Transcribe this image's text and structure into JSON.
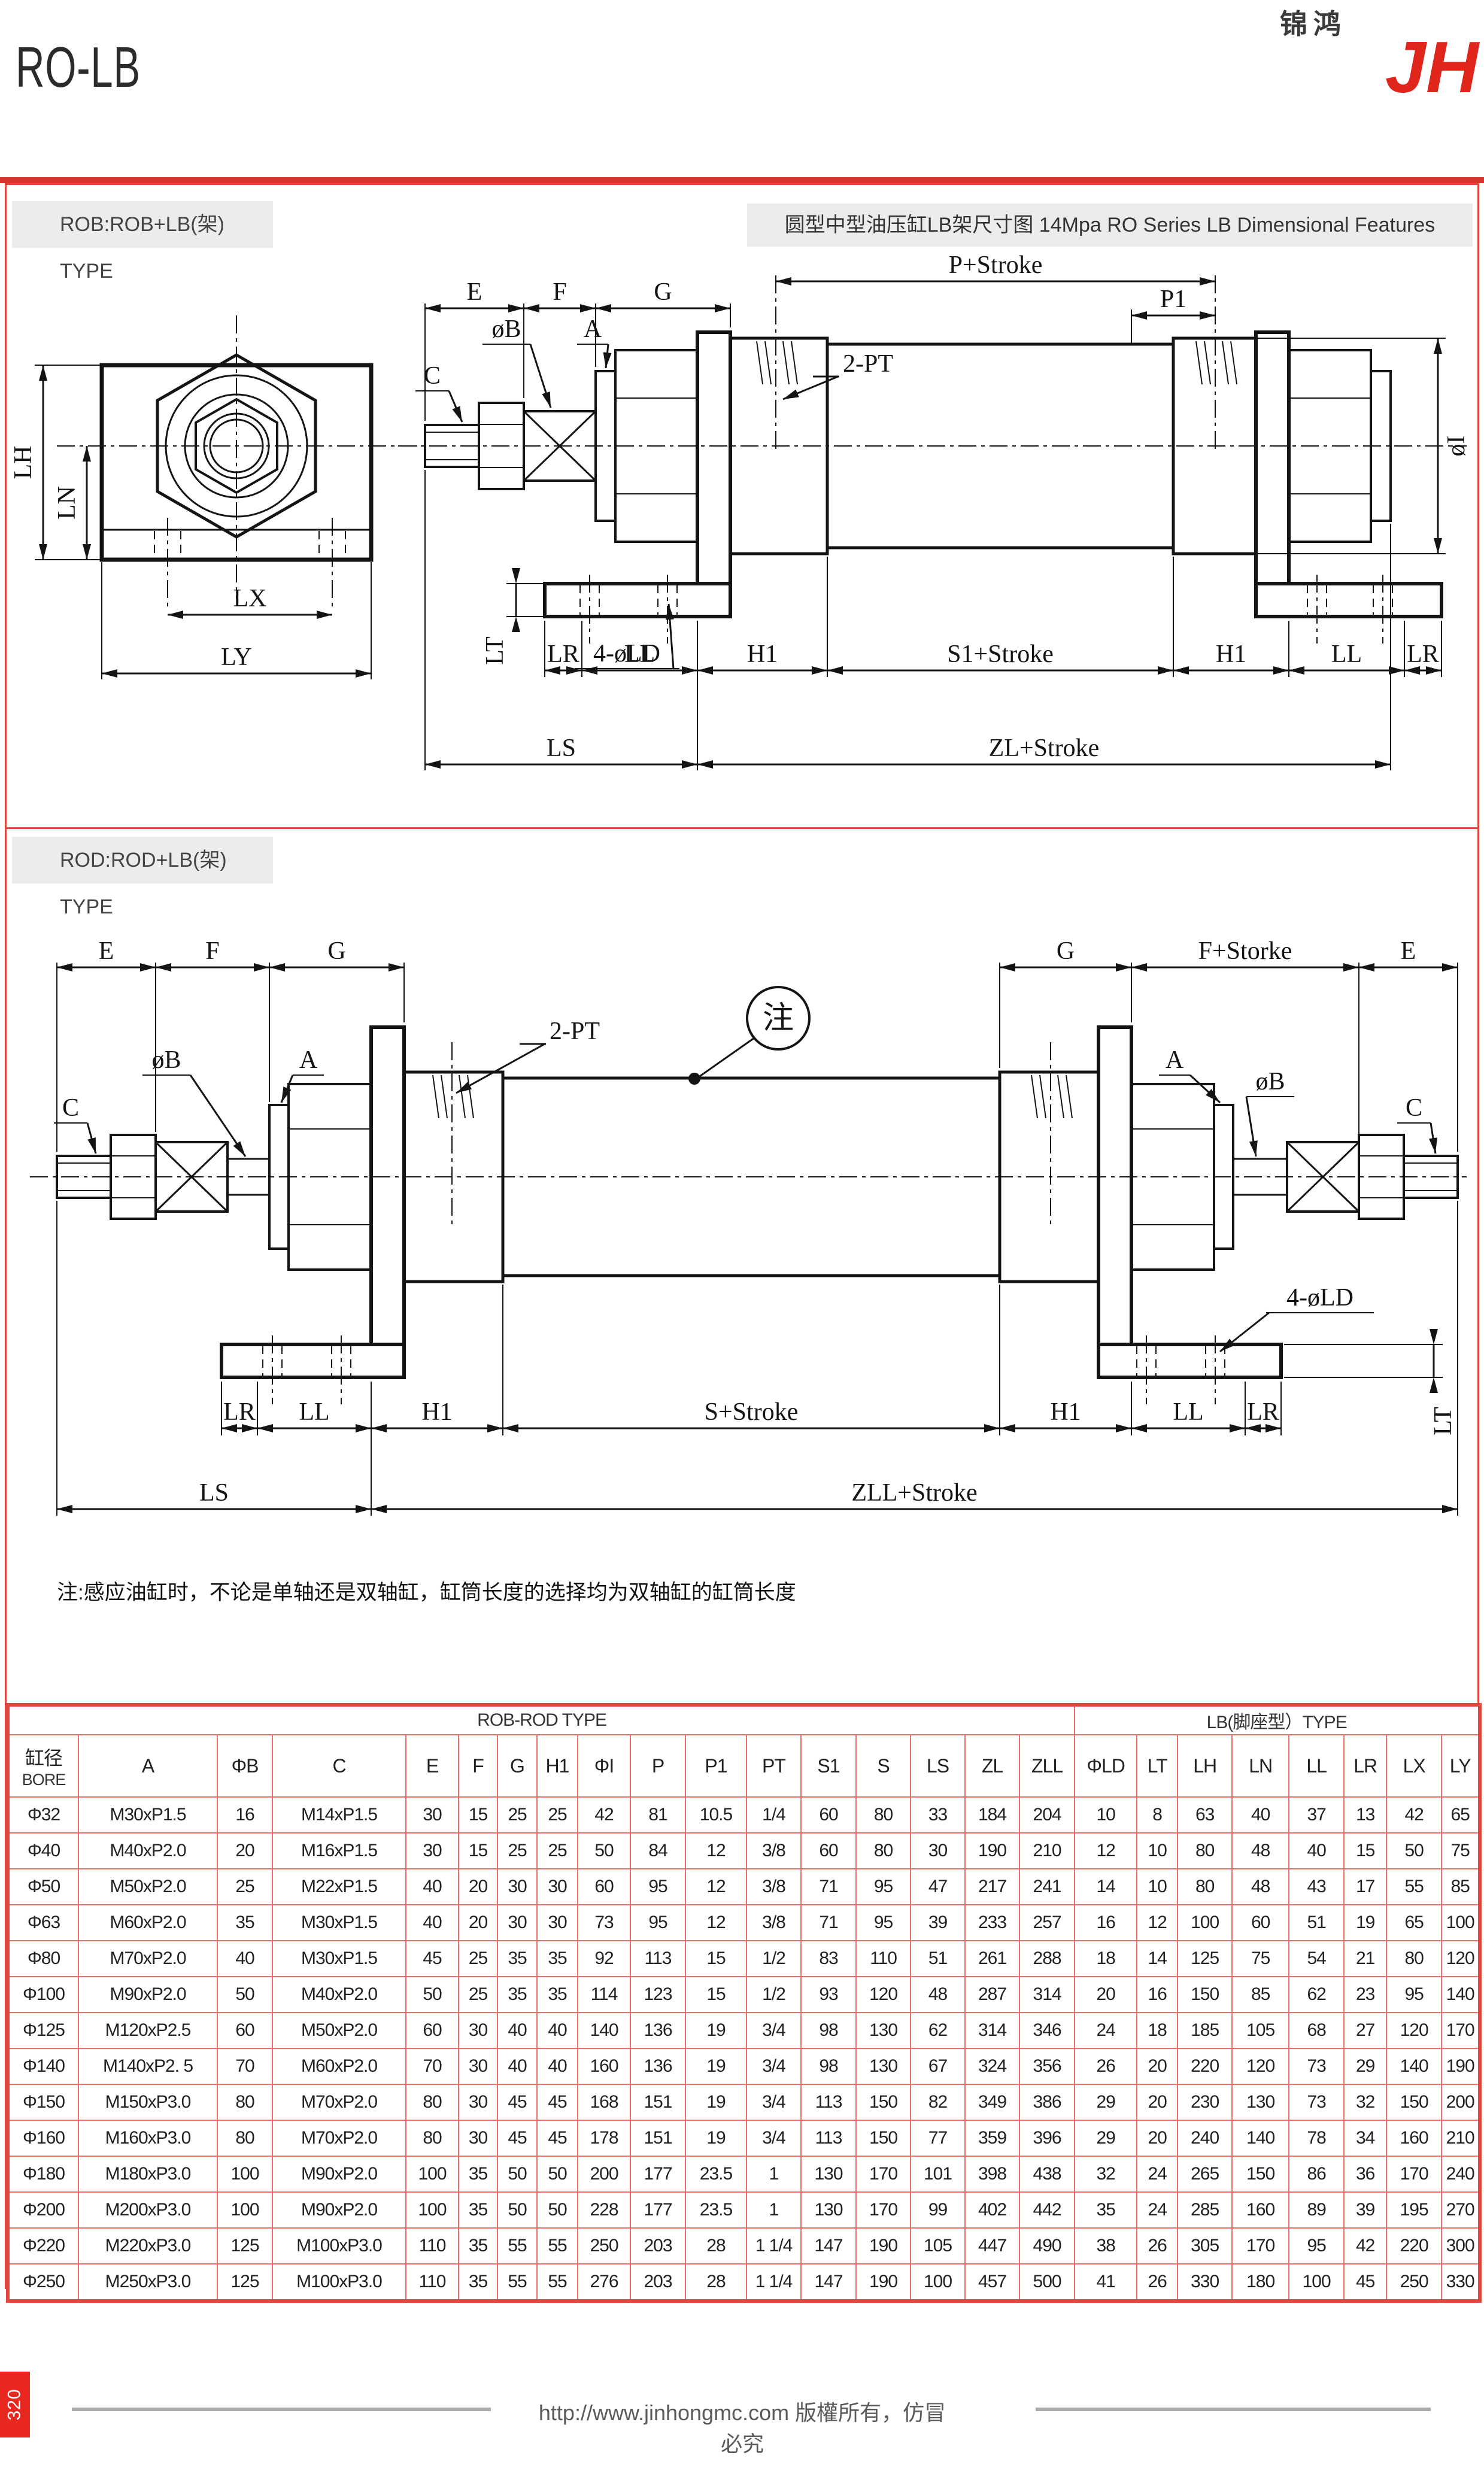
{
  "header": {
    "title": "RO-LB",
    "logo_cn": "锦鸿",
    "logo_latin": "JH"
  },
  "sec1": {
    "label": "ROB:ROB+LB(架) TYPE",
    "title": "圆型中型油压缸LB架尺寸图 14Mpa RO Series LB Dimensional Features"
  },
  "sec2": {
    "label": "ROD:ROD+LB(架) TYPE",
    "note": "注:感应油缸时，不论是单轴还是双轴缸，缸筒长度的选择均为双轴缸的缸筒长度"
  },
  "d1": {
    "E": "E",
    "F": "F",
    "G": "G",
    "P_stroke": "P+Stroke",
    "P1": "P1",
    "PT2": "2-PT",
    "C": "C",
    "phiB": "øB",
    "A": "A",
    "phiI": "øI",
    "LD4": "4-øLD",
    "LT": "LT",
    "LR": "LR",
    "LL": "LL",
    "H1": "H1",
    "S1_stroke": "S1+Stroke",
    "LS": "LS",
    "ZL_stroke": "ZL+Stroke",
    "LH": "LH",
    "LN": "LN",
    "LX": "LX",
    "LY": "LY"
  },
  "d2": {
    "E": "E",
    "F": "F",
    "G": "G",
    "F_storke": "F+Storke",
    "note_mark": "注",
    "PT2": "2-PT",
    "phiB": "øB",
    "A": "A",
    "C": "C",
    "LD4": "4-øLD",
    "LT": "LT",
    "LR": "LR",
    "LL": "LL",
    "H1": "H1",
    "S_stroke": "S+Stroke",
    "LS": "LS",
    "ZLL_stroke": "ZLL+Stroke"
  },
  "table": {
    "group_left": "ROB-ROD TYPE",
    "group_right": "LB(脚座型）TYPE",
    "bore_cn": "缸径",
    "bore_en": "BORE",
    "columns": [
      "A",
      "ΦB",
      "C",
      "E",
      "F",
      "G",
      "H1",
      "ΦI",
      "P",
      "P1",
      "PT",
      "S1",
      "S",
      "LS",
      "ZL",
      "ZLL",
      "ΦLD",
      "LT",
      "LH",
      "LN",
      "LL",
      "LR",
      "LX",
      "LY"
    ],
    "rows": [
      [
        "Φ32",
        "M30xP1.5",
        "16",
        "M14xP1.5",
        "30",
        "15",
        "25",
        "25",
        "42",
        "81",
        "10.5",
        "1/4",
        "60",
        "80",
        "33",
        "184",
        "204",
        "10",
        "8",
        "63",
        "40",
        "37",
        "13",
        "42",
        "65"
      ],
      [
        "Φ40",
        "M40xP2.0",
        "20",
        "M16xP1.5",
        "30",
        "15",
        "25",
        "25",
        "50",
        "84",
        "12",
        "3/8",
        "60",
        "80",
        "30",
        "190",
        "210",
        "12",
        "10",
        "80",
        "48",
        "40",
        "15",
        "50",
        "75"
      ],
      [
        "Φ50",
        "M50xP2.0",
        "25",
        "M22xP1.5",
        "40",
        "20",
        "30",
        "30",
        "60",
        "95",
        "12",
        "3/8",
        "71",
        "95",
        "47",
        "217",
        "241",
        "14",
        "10",
        "80",
        "48",
        "43",
        "17",
        "55",
        "85"
      ],
      [
        "Φ63",
        "M60xP2.0",
        "35",
        "M30xP1.5",
        "40",
        "20",
        "30",
        "30",
        "73",
        "95",
        "12",
        "3/8",
        "71",
        "95",
        "39",
        "233",
        "257",
        "16",
        "12",
        "100",
        "60",
        "51",
        "19",
        "65",
        "100"
      ],
      [
        "Φ80",
        "M70xP2.0",
        "40",
        "M30xP1.5",
        "45",
        "25",
        "35",
        "35",
        "92",
        "113",
        "15",
        "1/2",
        "83",
        "110",
        "51",
        "261",
        "288",
        "18",
        "14",
        "125",
        "75",
        "54",
        "21",
        "80",
        "120"
      ],
      [
        "Φ100",
        "M90xP2.0",
        "50",
        "M40xP2.0",
        "50",
        "25",
        "35",
        "35",
        "114",
        "123",
        "15",
        "1/2",
        "93",
        "120",
        "48",
        "287",
        "314",
        "20",
        "16",
        "150",
        "85",
        "62",
        "23",
        "95",
        "140"
      ],
      [
        "Φ125",
        "M120xP2.5",
        "60",
        "M50xP2.0",
        "60",
        "30",
        "40",
        "40",
        "140",
        "136",
        "19",
        "3/4",
        "98",
        "130",
        "62",
        "314",
        "346",
        "24",
        "18",
        "185",
        "105",
        "68",
        "27",
        "120",
        "170"
      ],
      [
        "Φ140",
        "M140xP2. 5",
        "70",
        "M60xP2.0",
        "70",
        "30",
        "40",
        "40",
        "160",
        "136",
        "19",
        "3/4",
        "98",
        "130",
        "67",
        "324",
        "356",
        "26",
        "20",
        "220",
        "120",
        "73",
        "29",
        "140",
        "190"
      ],
      [
        "Φ150",
        "M150xP3.0",
        "80",
        "M70xP2.0",
        "80",
        "30",
        "45",
        "45",
        "168",
        "151",
        "19",
        "3/4",
        "113",
        "150",
        "82",
        "349",
        "386",
        "29",
        "20",
        "230",
        "130",
        "73",
        "32",
        "150",
        "200"
      ],
      [
        "Φ160",
        "M160xP3.0",
        "80",
        "M70xP2.0",
        "80",
        "30",
        "45",
        "45",
        "178",
        "151",
        "19",
        "3/4",
        "113",
        "150",
        "77",
        "359",
        "396",
        "29",
        "20",
        "240",
        "140",
        "78",
        "34",
        "160",
        "210"
      ],
      [
        "Φ180",
        "M180xP3.0",
        "100",
        "M90xP2.0",
        "100",
        "35",
        "50",
        "50",
        "200",
        "177",
        "23.5",
        "1",
        "130",
        "170",
        "101",
        "398",
        "438",
        "32",
        "24",
        "265",
        "150",
        "86",
        "36",
        "170",
        "240"
      ],
      [
        "Φ200",
        "M200xP3.0",
        "100",
        "M90xP2.0",
        "100",
        "35",
        "50",
        "50",
        "228",
        "177",
        "23.5",
        "1",
        "130",
        "170",
        "99",
        "402",
        "442",
        "35",
        "24",
        "285",
        "160",
        "89",
        "39",
        "195",
        "270"
      ],
      [
        "Φ220",
        "M220xP3.0",
        "125",
        "M100xP3.0",
        "110",
        "35",
        "55",
        "55",
        "250",
        "203",
        "28",
        "1 1/4",
        "147",
        "190",
        "105",
        "447",
        "490",
        "38",
        "26",
        "305",
        "170",
        "95",
        "42",
        "220",
        "300"
      ],
      [
        "Φ250",
        "M250xP3.0",
        "125",
        "M100xP3.0",
        "110",
        "35",
        "55",
        "55",
        "276",
        "203",
        "28",
        "1 1/4",
        "147",
        "190",
        "100",
        "457",
        "500",
        "41",
        "26",
        "330",
        "180",
        "100",
        "45",
        "250",
        "330"
      ]
    ]
  },
  "footer": {
    "page_number": "320",
    "url": "http://www.jinhongmc.com 版權所有，仿冒必究"
  },
  "colors": {
    "accent_red": "#d5352b",
    "table_line": "#ef6f66",
    "table_border": "#e2473d",
    "logo_red": "#e0251b"
  }
}
